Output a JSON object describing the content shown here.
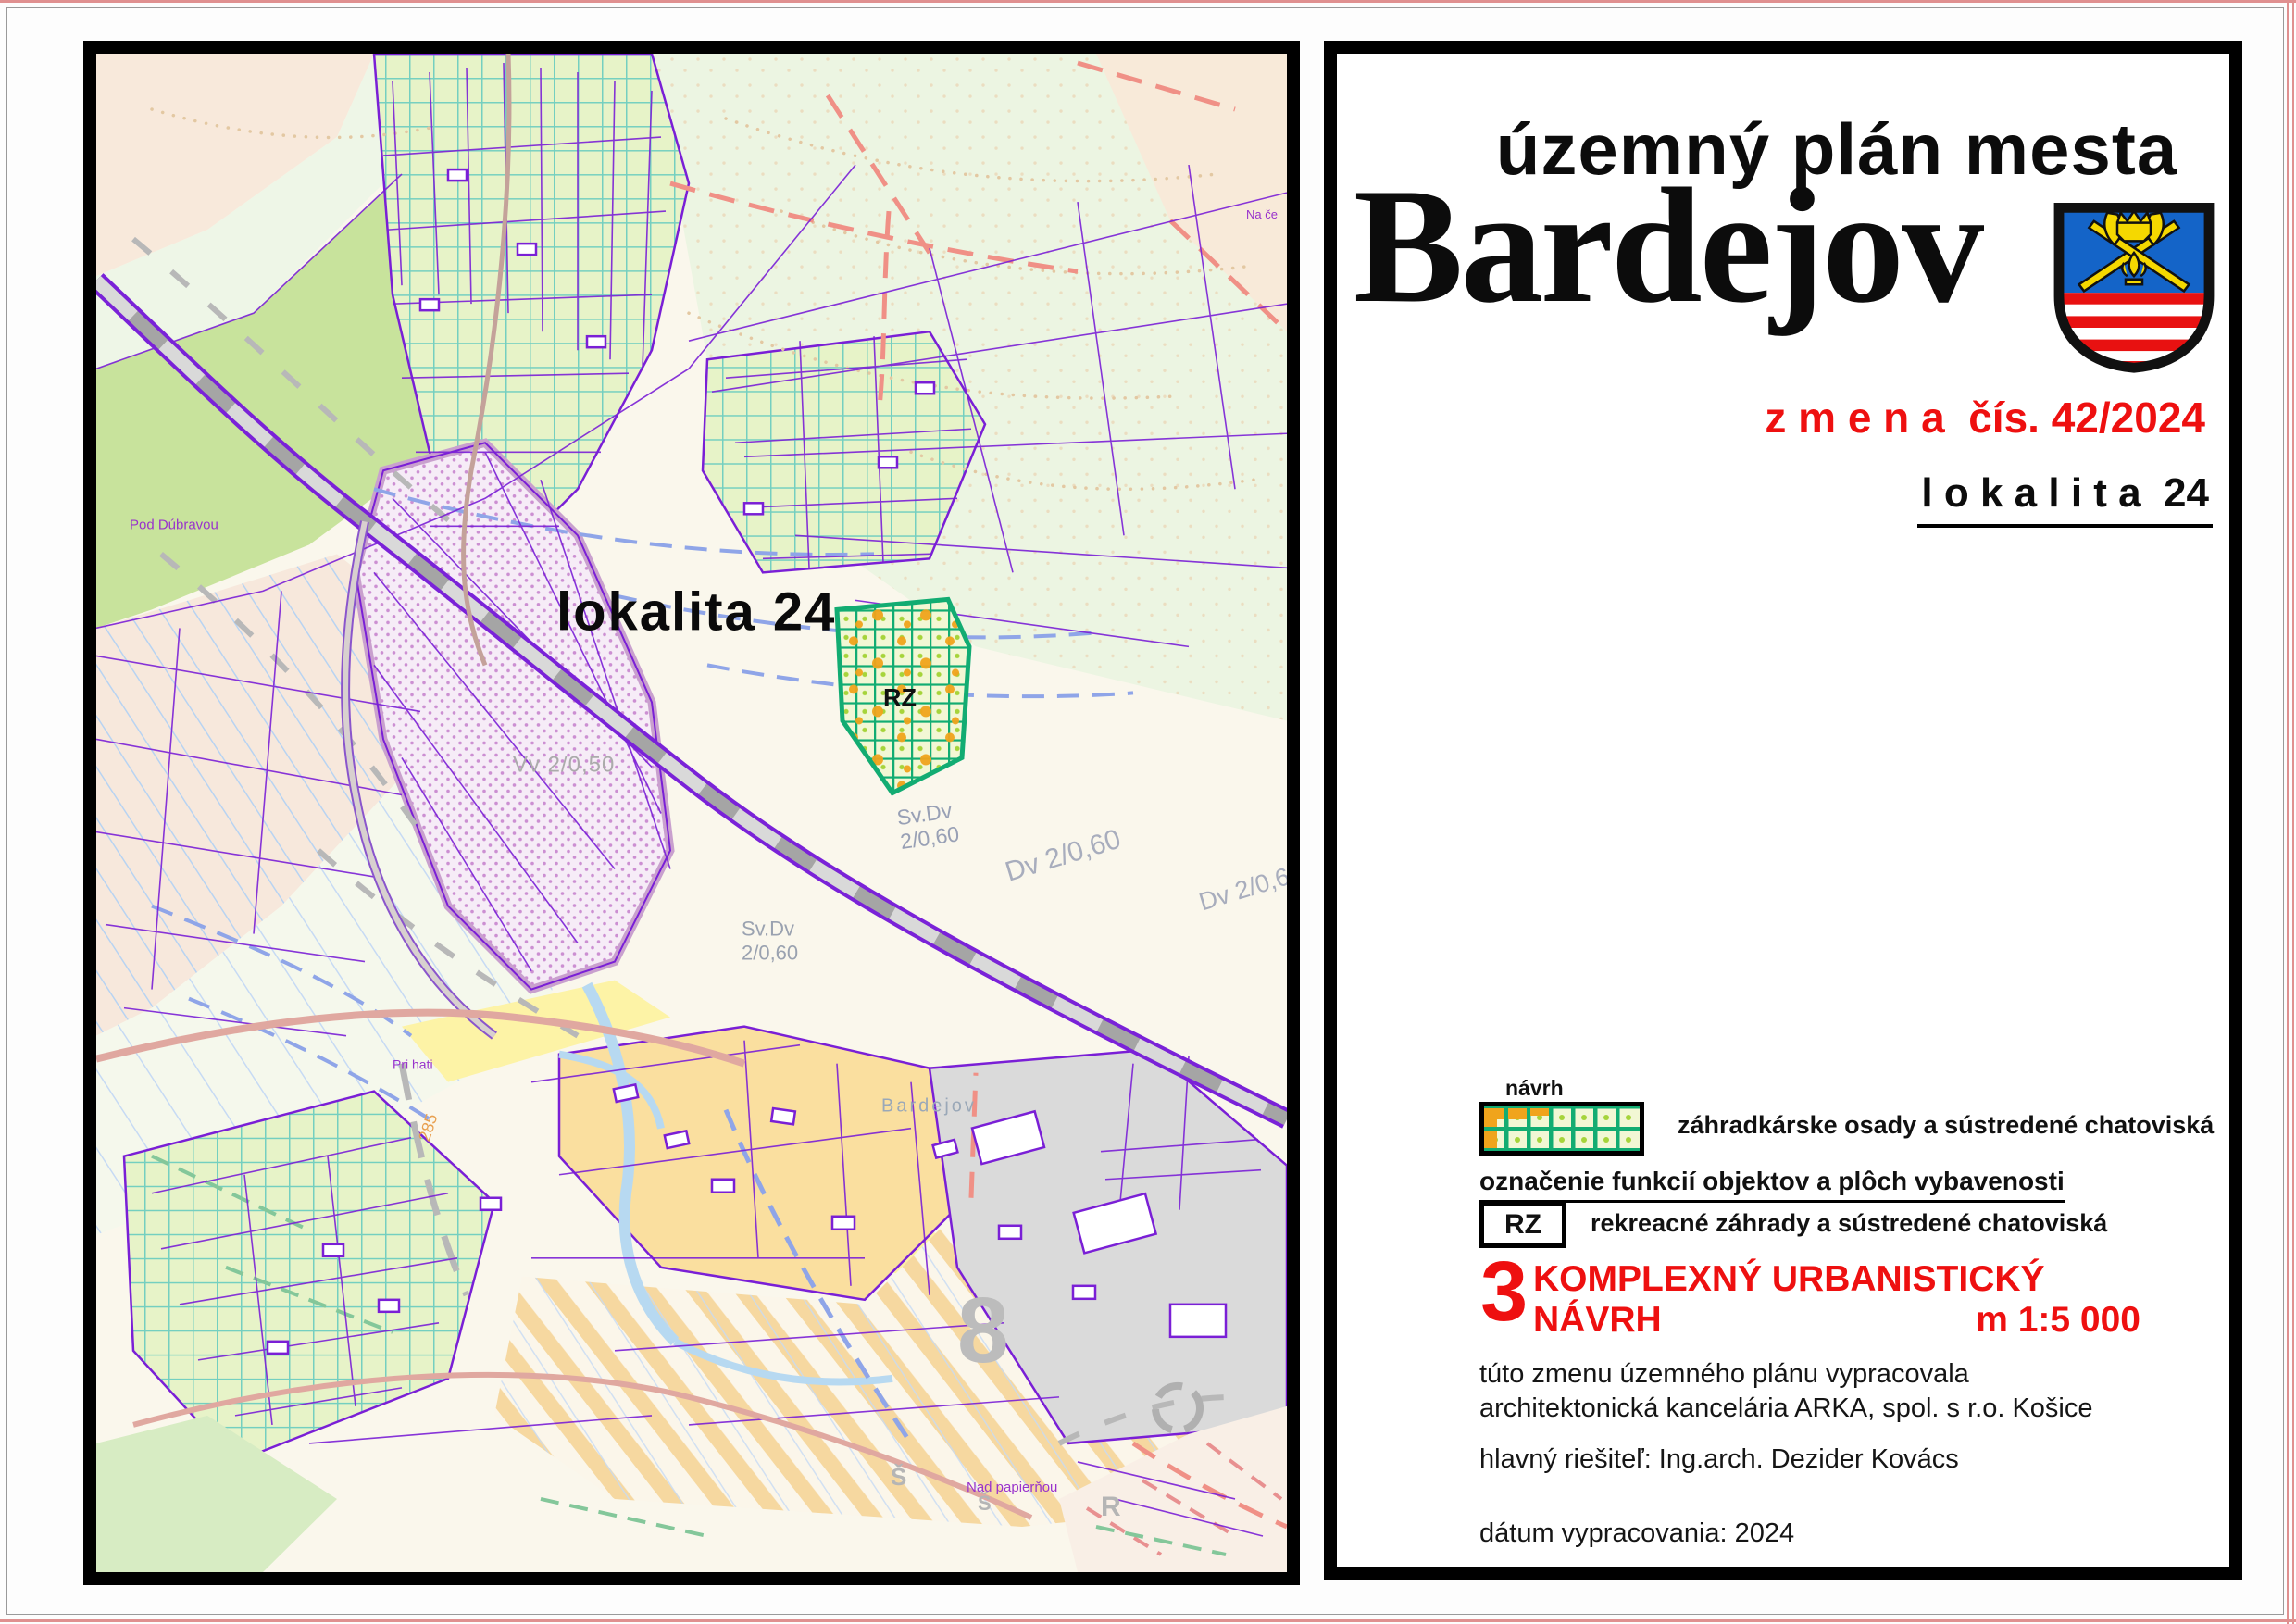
{
  "colors": {
    "accent_red": "#ee1010",
    "rz_grid_green": "#12ac72",
    "rz_orange": "#f0a41c",
    "garden_teal": "#74cfc0",
    "shield_blue": "#1464c8",
    "shield_yellow": "#f5d800",
    "shield_red": "#e81111",
    "parcel_purple": "#7a1fd6"
  },
  "map": {
    "labels": {
      "lokalita": "lokalita 24",
      "rz": "RZ",
      "sv_dv_a1": "Sv.Dv",
      "sv_dv_a2": "2/0,60",
      "dv_60": "Dv 2/0,60",
      "dv_6": "Dv 2/0,6",
      "sv_dv_b1": "Sv.Dv",
      "sv_dv_b2": "2/0,60",
      "vv": "Vv 2/0,50",
      "bardejov_small": "Bardejov",
      "pod_dubravou": "Pod Dúbravou",
      "pri_hati": "Pri hati",
      "road_285": "285",
      "nad_papiernou": "Nad papierňou",
      "sector_8": "8",
      "letter_s1": "Š",
      "letter_s2": "Š",
      "letter_r": "R",
      "na_ce": "Na če"
    }
  },
  "panel": {
    "title_top": "územný plán mesta",
    "title_city": "Bardejov",
    "change_line": "z m e n a  čís. 42/2024",
    "lokalita_line": "l o k a l i t a  24",
    "legend": {
      "navrh_label": "návrh",
      "garden_label": "záhradkárske osady a sústredené chatoviská",
      "section_heading": "označenie funkcií objektov a plôch vybavenosti",
      "rz_code": "RZ",
      "rz_label": "rekreacné záhrady a sústredené chatoviská"
    },
    "sheet": {
      "number": "3",
      "name": "KOMPLEXNÝ URBANISTICKÝ NÁVRH",
      "scale": "m 1:5 000"
    },
    "credits": {
      "line1": "túto zmenu územného plánu vypracovala",
      "line2": "architektonická kancelária ARKA, spol. s r.o. Košice",
      "resitel": "hlavný riešiteľ: Ing.arch. Dezider Kovács",
      "datum": "dátum vypracovania: 2024"
    }
  }
}
